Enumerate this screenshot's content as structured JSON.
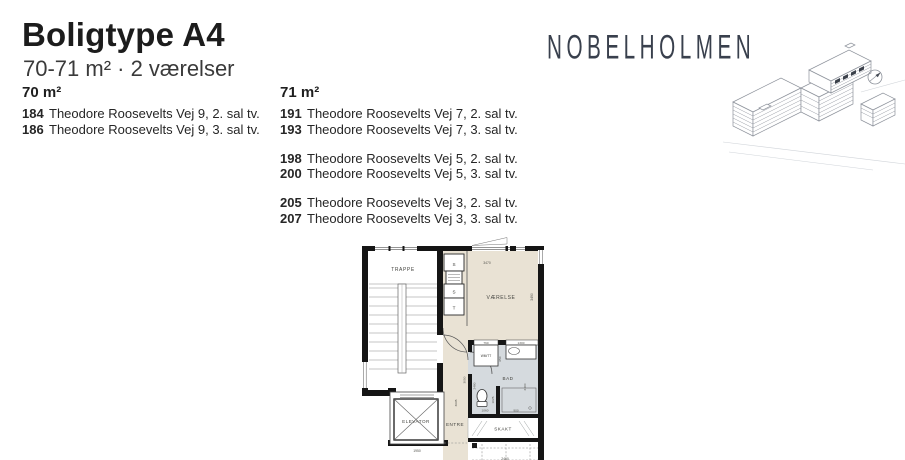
{
  "header": {
    "title": "Boligtype A4",
    "subtitle": "70-71 m² · 2 værelser"
  },
  "brand": {
    "logo": "NOBELHOLMEN"
  },
  "listings": {
    "columns": [
      {
        "header": "70 m²",
        "groups": [
          [
            {
              "num": "184",
              "addr": "Theodore Roosevelts Vej 9, 2. sal tv."
            },
            {
              "num": "186",
              "addr": "Theodore Roosevelts Vej 9, 3. sal tv."
            }
          ]
        ]
      },
      {
        "header": "71 m²",
        "groups": [
          [
            {
              "num": "191",
              "addr": "Theodore Roosevelts Vej 7, 2. sal tv."
            },
            {
              "num": "193",
              "addr": "Theodore Roosevelts Vej 7, 3. sal tv."
            }
          ],
          [
            {
              "num": "198",
              "addr": "Theodore Roosevelts Vej 5, 2. sal tv."
            },
            {
              "num": "200",
              "addr": "Theodore Roosevelts Vej 5, 3. sal tv."
            }
          ],
          [
            {
              "num": "205",
              "addr": "Theodore Roosevelts Vej 3, 2. sal tv."
            },
            {
              "num": "207",
              "addr": "Theodore Roosevelts Vej 3, 3. sal tv."
            }
          ]
        ]
      }
    ]
  },
  "floorplan": {
    "labels": {
      "trappe": "TRAPPE",
      "vaerelse": "VÆRELSE",
      "bad": "BAD",
      "entre": "ENTRE",
      "elevator": "ELEVATOR",
      "skakt": "SKAKT",
      "closet_s_top": "S",
      "closet_s_mid": "S",
      "closet_t": "T",
      "wm_tt": "WM/TT"
    },
    "dims": {
      "vaerelse_w": "3470",
      "vaerelse_h": "3490",
      "wm_w": "760",
      "sink_w": "1300",
      "wm_d": "650",
      "bad_h_left": "2480",
      "bad_h_right": "2400",
      "toilet_w": "1060",
      "shower_w": "900",
      "shower_d": "1025",
      "entre_h": "3695",
      "entre_h2": "3050",
      "elevator_w": "1950",
      "bottom_w": "2460"
    },
    "colors": {
      "room": "#e9e2d4",
      "bath": "#d5dade",
      "wall": "#151515"
    }
  },
  "illustration": {
    "name": "site-building-axonometric",
    "compass": "north-arrow"
  }
}
